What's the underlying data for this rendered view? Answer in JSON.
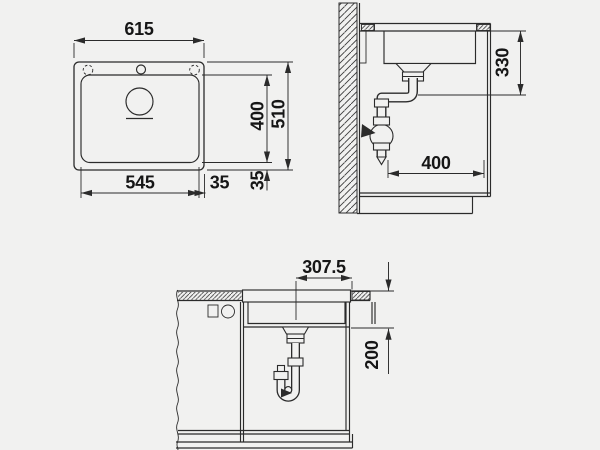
{
  "drawing": {
    "title": "sink installation dimension drawing",
    "colors": {
      "background": "#f1f1f0",
      "line": "#2b2b2b",
      "text": "#161616"
    },
    "top_view": {
      "overall_width": "615",
      "bowl_width": "545",
      "side_offset": "35",
      "front_offset": "35",
      "bowl_depth": "400",
      "overall_depth": "510"
    },
    "side_view": {
      "height_to_drain": "330",
      "install_depth": "400"
    },
    "front_view": {
      "center_offset": "307.5",
      "drop_height": "200"
    }
  }
}
